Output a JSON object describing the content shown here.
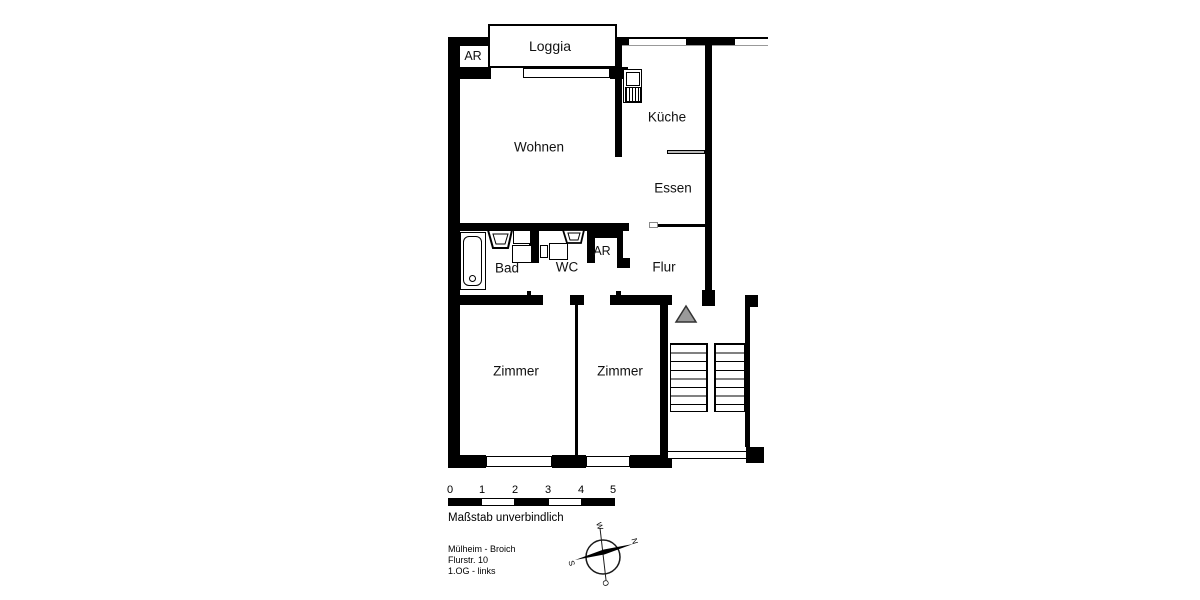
{
  "rooms": [
    {
      "id": "loggia",
      "label": "Loggia"
    },
    {
      "id": "ar-top",
      "label": "AR"
    },
    {
      "id": "wohnen",
      "label": "Wohnen"
    },
    {
      "id": "kueche",
      "label": "Küche"
    },
    {
      "id": "essen",
      "label": "Essen"
    },
    {
      "id": "flur",
      "label": "Flur"
    },
    {
      "id": "bad",
      "label": "Bad"
    },
    {
      "id": "wc",
      "label": "WC"
    },
    {
      "id": "ar-mid",
      "label": "AR"
    },
    {
      "id": "zimmer-left",
      "label": "Zimmer"
    },
    {
      "id": "zimmer-right",
      "label": "Zimmer"
    }
  ],
  "scale": {
    "ticks": [
      "0",
      "1",
      "2",
      "3",
      "4",
      "5"
    ],
    "caption": "Maßstab unverbindlich"
  },
  "address": {
    "lines": [
      "Mülheim - Broich",
      "Flurstr. 10",
      "1.OG - links"
    ]
  },
  "compass": {
    "north": "N",
    "east": "O",
    "south": "S",
    "west": "W"
  },
  "colors": {
    "wall": "#000000",
    "entrance_triangle": "#9a9a9a",
    "counter_fill": "#b8b8b8"
  }
}
